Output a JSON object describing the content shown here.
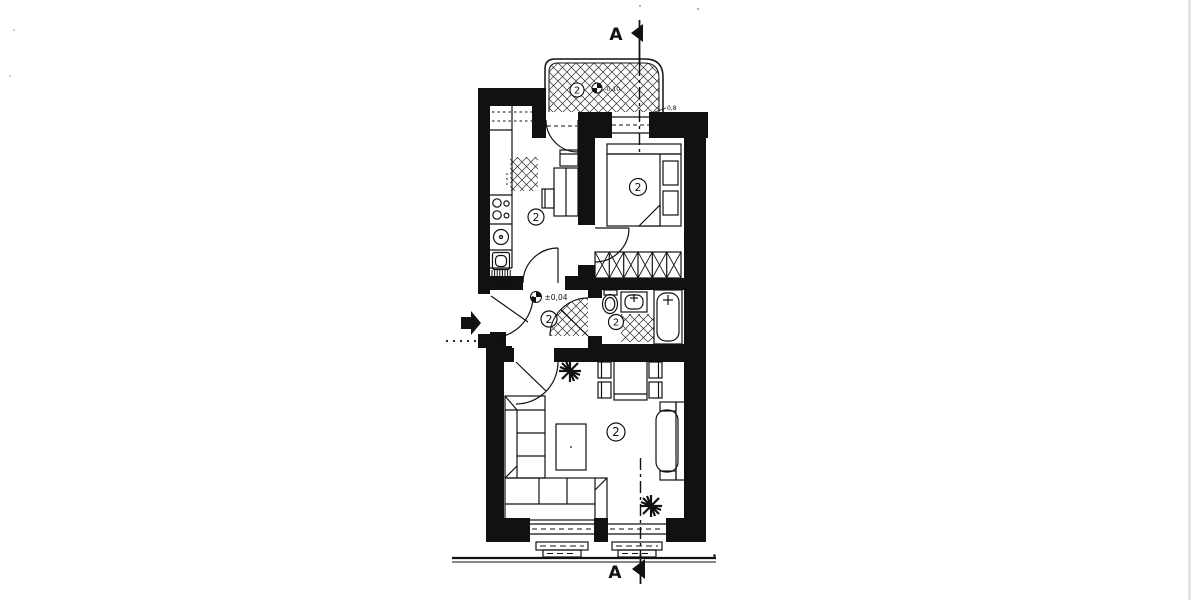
{
  "palette": {
    "ink": "#111111",
    "paper": "#ffffff",
    "hatch": "#2a2a2a",
    "scan_edge": "#cfcfcf"
  },
  "plan": {
    "section_marks": {
      "top": "A",
      "bottom": "A"
    },
    "levels": {
      "hall": "±0,04",
      "balcony": "-0,10"
    },
    "notes": {
      "edge": "0,8"
    },
    "rooms": {
      "balcony": {
        "label": "2"
      },
      "kitchen": {
        "label": "2"
      },
      "bedroom": {
        "label": "2"
      },
      "hall": {
        "label": "2"
      },
      "bathroom": {
        "label": "2"
      },
      "living_room": {
        "label": "2"
      }
    }
  }
}
